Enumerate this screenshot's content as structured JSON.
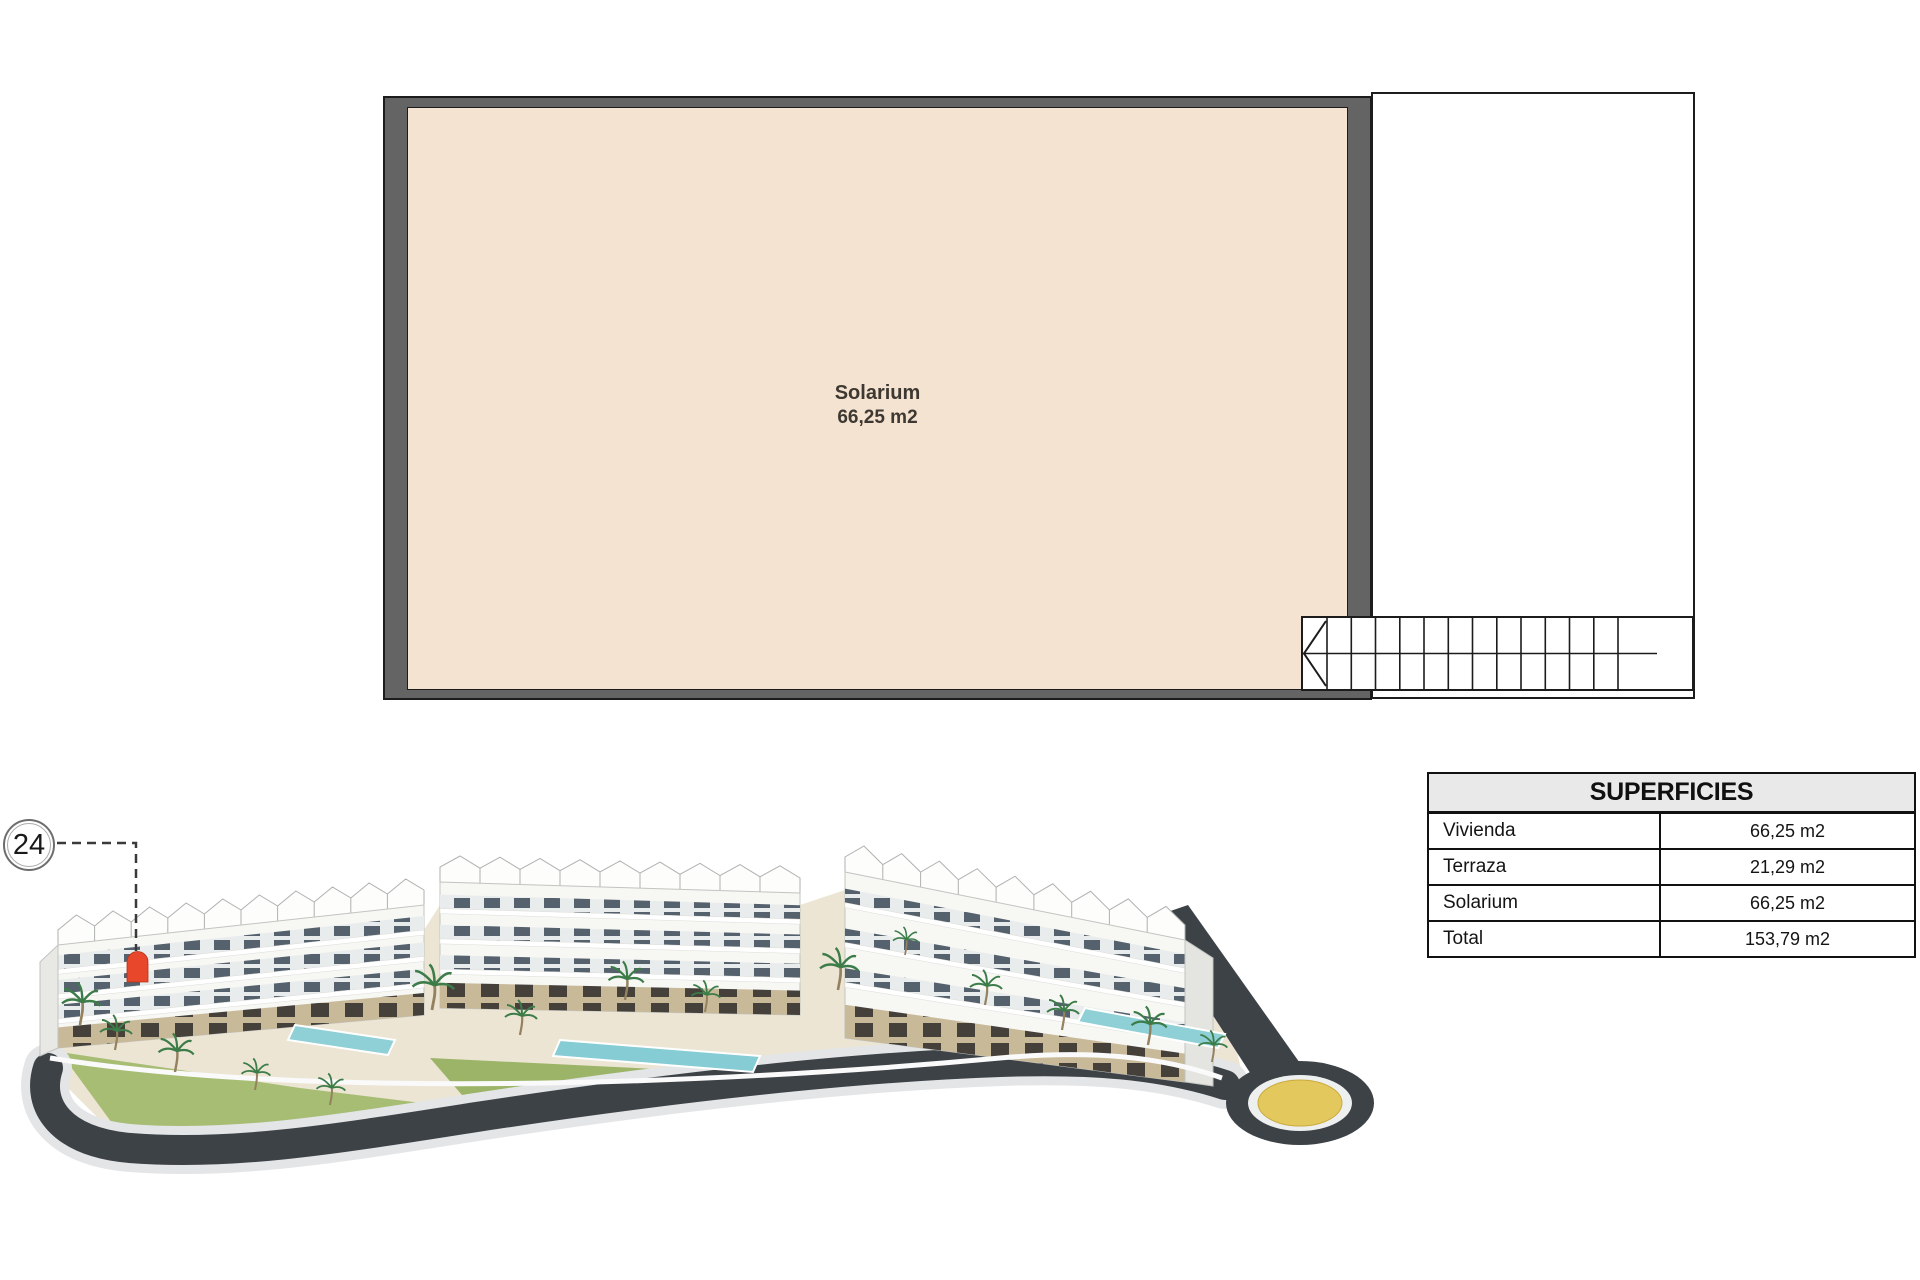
{
  "plan": {
    "room_label": "Solarium",
    "room_area": "66,25 m2"
  },
  "callout": {
    "number": "24"
  },
  "table": {
    "title": "SUPERFICIES",
    "rows": [
      {
        "label": "Vivienda",
        "value": "66,25 m2"
      },
      {
        "label": "Terraza",
        "value": "21,29 m2"
      },
      {
        "label": "Solarium",
        "value": "66,25 m2"
      },
      {
        "label": "Total",
        "value": "153,79 m2"
      }
    ]
  },
  "colors": {
    "floor_fill": "#f5e3d1",
    "wall_gray": "#646464",
    "marker_red": "#e8472b",
    "road_dark": "#3d4247",
    "roundabout_yellow": "#e3c85e",
    "table_header_bg": "#e9e9e9"
  }
}
